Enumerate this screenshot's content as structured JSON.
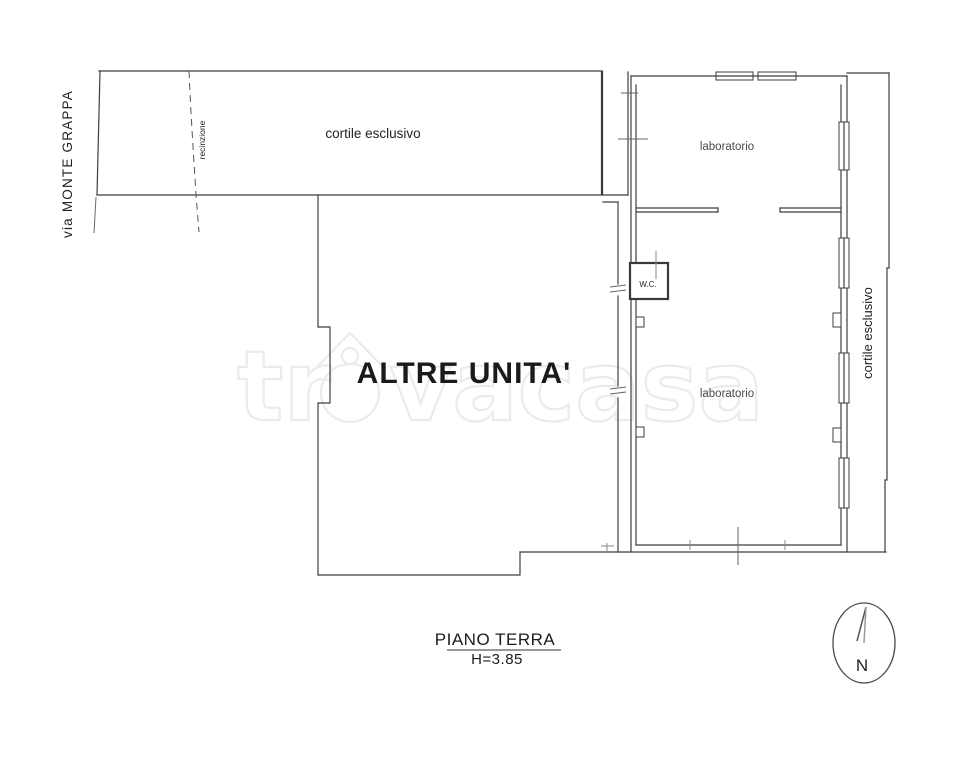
{
  "labels": {
    "street": "via MONTE GRAPPA",
    "fence": "recinzione",
    "courtyard_top": "cortile esclusivo",
    "courtyard_right": "cortile esclusivo",
    "laboratory_upper": "laboratorio",
    "laboratory_lower": "laboratorio",
    "wc": "W.C.",
    "other_units": "ALTRE UNITA'",
    "compass_north": "N"
  },
  "title": {
    "floor_name": "PIANO TERRA",
    "floor_height": "H=3.85"
  },
  "watermark": {
    "prefix": "tr",
    "suffix": "vacasa",
    "brand": "trovacasa"
  },
  "colors": {
    "wall": "#3f3f3f",
    "tick": "#8a8a8a",
    "watermark": "#ebebeb",
    "background": "#ffffff"
  }
}
